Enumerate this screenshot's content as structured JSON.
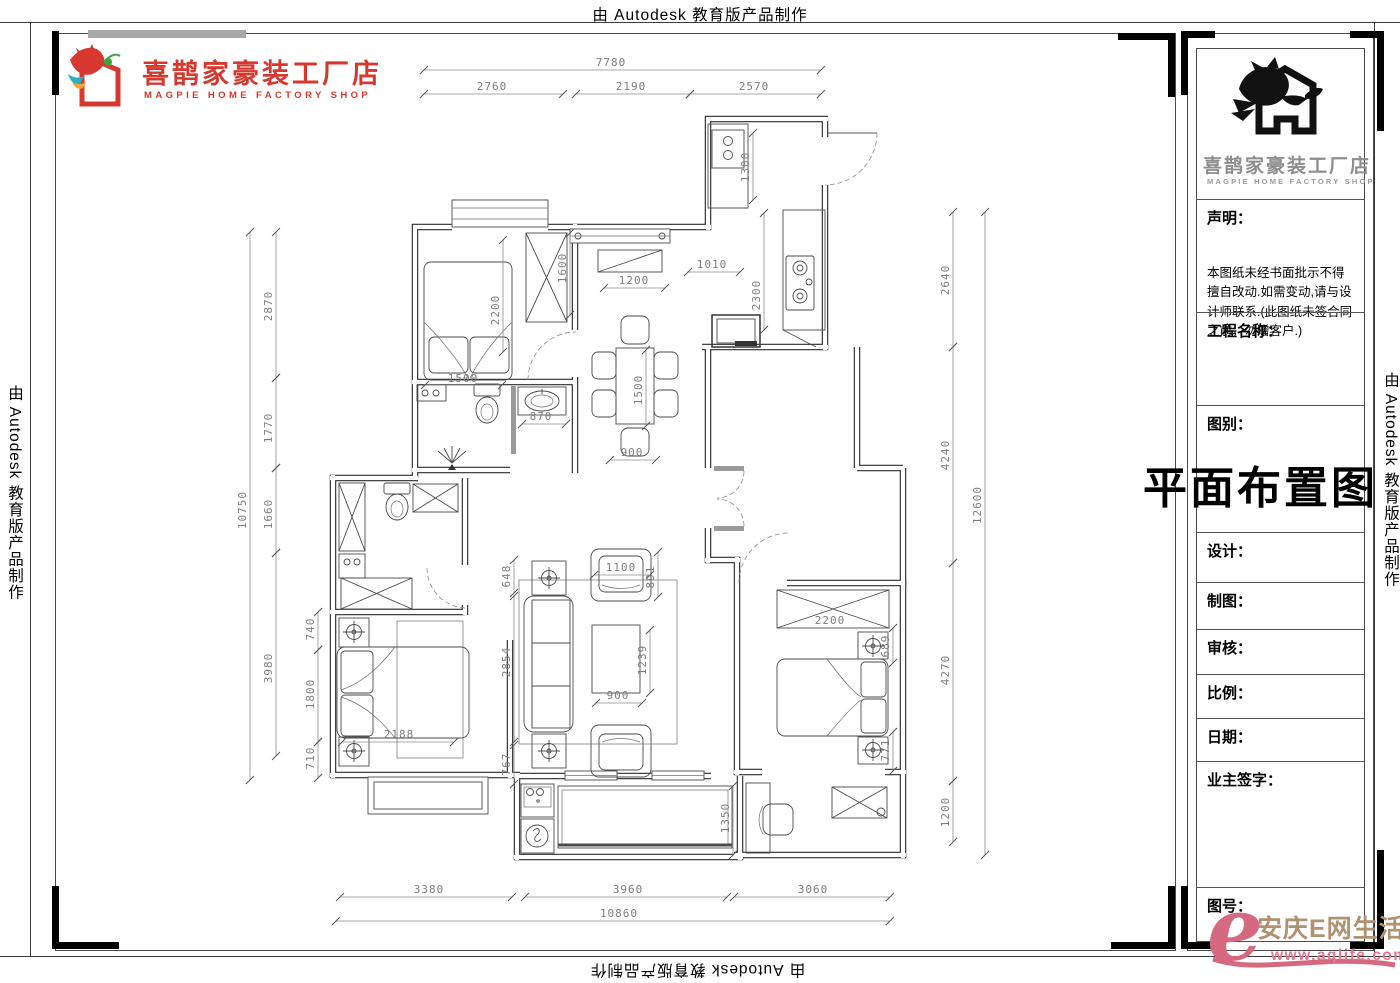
{
  "border_texts": {
    "top": "由 Autodesk 教育版产品制作",
    "left": "由 Autodesk 教育版产品制作",
    "right": "由 Autodesk 教育版产品制作",
    "bottom": "由 Autodesk 教育版产品制作"
  },
  "brand": {
    "name_cn": "喜鹊家豪装工厂店",
    "name_en": "MAGPIE HOME FACTORY SHOP",
    "color": "#d6382f"
  },
  "title_block": {
    "logo_cn": "喜鹊家豪装工厂店",
    "logo_en": "MAGPIE HOME FACTORY SHOP",
    "statement_label": "声明：",
    "statement_text": "本图纸未经书面批示不得擅自改动.如需变动,请与设计师联系.(此图纸未签合同之前，勿赠客户.)",
    "project_label": "工程名称：",
    "category_label": "图别：",
    "drawing_title": "平面布置图",
    "designer_label": "设计：",
    "drafter_label": "制图：",
    "reviewer_label": "审核：",
    "scale_label": "比例：",
    "date_label": "日期：",
    "owner_sign_label": "业主签字：",
    "sheet_no_label": "图号："
  },
  "watermark": {
    "mark": "e",
    "site_cn": "安庆E网生活",
    "site_url": "www.aqlife.com"
  },
  "plan": {
    "dimensions": [
      {
        "v": "7780",
        "x1": 424,
        "y1": 70,
        "x2": 821,
        "y2": 70,
        "lx": 611,
        "ly": 66
      },
      {
        "v": "2760",
        "x1": 424,
        "y1": 94,
        "x2": 563,
        "y2": 94,
        "lx": 492,
        "ly": 90
      },
      {
        "v": "2190",
        "x1": 576,
        "y1": 94,
        "x2": 690,
        "y2": 94,
        "lx": 631,
        "ly": 90
      },
      {
        "v": "2570",
        "x1": 690,
        "y1": 94,
        "x2": 821,
        "y2": 94,
        "lx": 754,
        "ly": 90
      },
      {
        "v": "10750",
        "x1": 250,
        "y1": 232,
        "x2": 250,
        "y2": 780,
        "lx": 246,
        "ly": 510,
        "r": -90
      },
      {
        "v": "2870",
        "x1": 276,
        "y1": 232,
        "x2": 276,
        "y2": 378,
        "lx": 272,
        "ly": 306,
        "r": -90
      },
      {
        "v": "1770",
        "x1": 276,
        "y1": 378,
        "x2": 276,
        "y2": 468,
        "lx": 272,
        "ly": 428,
        "r": -90
      },
      {
        "v": "1660",
        "x1": 276,
        "y1": 468,
        "x2": 276,
        "y2": 553,
        "lx": 272,
        "ly": 514,
        "r": -90
      },
      {
        "v": "3980",
        "x1": 276,
        "y1": 553,
        "x2": 276,
        "y2": 756,
        "lx": 272,
        "ly": 668,
        "r": -90
      },
      {
        "v": "2640",
        "x1": 953,
        "y1": 212,
        "x2": 953,
        "y2": 347,
        "lx": 949,
        "ly": 280,
        "r": -90
      },
      {
        "v": "4240",
        "x1": 953,
        "y1": 347,
        "x2": 953,
        "y2": 563,
        "lx": 949,
        "ly": 455,
        "r": -90
      },
      {
        "v": "4270",
        "x1": 953,
        "y1": 563,
        "x2": 953,
        "y2": 781,
        "lx": 949,
        "ly": 670,
        "r": -90
      },
      {
        "v": "1200",
        "x1": 953,
        "y1": 781,
        "x2": 953,
        "y2": 842,
        "lx": 949,
        "ly": 812,
        "r": -90
      },
      {
        "v": "12600",
        "x1": 985,
        "y1": 212,
        "x2": 985,
        "y2": 855,
        "lx": 981,
        "ly": 505,
        "r": -90
      },
      {
        "v": "3380",
        "x1": 340,
        "y1": 897,
        "x2": 512,
        "y2": 897,
        "lx": 429,
        "ly": 893
      },
      {
        "v": "3960",
        "x1": 525,
        "y1": 897,
        "x2": 727,
        "y2": 897,
        "lx": 628,
        "ly": 893
      },
      {
        "v": "3060",
        "x1": 734,
        "y1": 897,
        "x2": 890,
        "y2": 897,
        "lx": 813,
        "ly": 893
      },
      {
        "v": "10860",
        "x1": 336,
        "y1": 921,
        "x2": 890,
        "y2": 921,
        "lx": 619,
        "ly": 917
      },
      {
        "v": "1300",
        "x1": 753,
        "y1": 133,
        "x2": 753,
        "y2": 200,
        "lx": 749,
        "ly": 167,
        "r": -90
      },
      {
        "v": "2300",
        "x1": 764,
        "y1": 213,
        "x2": 764,
        "y2": 330,
        "lx": 760,
        "ly": 295,
        "r": -90
      },
      {
        "v": "1010",
        "x1": 688,
        "y1": 272,
        "x2": 740,
        "y2": 272,
        "lx": 712,
        "ly": 268
      },
      {
        "v": "1200",
        "x1": 604,
        "y1": 288,
        "x2": 665,
        "y2": 288,
        "lx": 634,
        "ly": 284
      },
      {
        "v": "1600",
        "x1": 570,
        "y1": 233,
        "x2": 570,
        "y2": 315,
        "lx": 566,
        "ly": 268,
        "r": -90
      },
      {
        "v": "2200",
        "x1": 503,
        "y1": 240,
        "x2": 503,
        "y2": 352,
        "lx": 499,
        "ly": 310,
        "r": -90
      },
      {
        "v": "1500",
        "x1": 425,
        "y1": 385,
        "x2": 502,
        "y2": 385,
        "lx": 463,
        "ly": 382
      },
      {
        "v": "870",
        "x1": 522,
        "y1": 424,
        "x2": 566,
        "y2": 424,
        "lx": 541,
        "ly": 420
      },
      {
        "v": "1500",
        "x1": 646,
        "y1": 350,
        "x2": 646,
        "y2": 426,
        "lx": 642,
        "ly": 390,
        "r": -90
      },
      {
        "v": "900",
        "x1": 610,
        "y1": 460,
        "x2": 656,
        "y2": 460,
        "lx": 632,
        "ly": 456
      },
      {
        "v": "648",
        "x1": 514,
        "y1": 560,
        "x2": 514,
        "y2": 593,
        "lx": 510,
        "ly": 576,
        "r": -90
      },
      {
        "v": "2854",
        "x1": 514,
        "y1": 596,
        "x2": 514,
        "y2": 742,
        "lx": 510,
        "ly": 662,
        "r": -90
      },
      {
        "v": "767",
        "x1": 514,
        "y1": 745,
        "x2": 514,
        "y2": 784,
        "lx": 510,
        "ly": 764,
        "r": -90
      },
      {
        "v": "1100",
        "x1": 594,
        "y1": 575,
        "x2": 650,
        "y2": 575,
        "lx": 621,
        "ly": 571
      },
      {
        "v": "891",
        "x1": 658,
        "y1": 552,
        "x2": 658,
        "y2": 597,
        "lx": 654,
        "ly": 577,
        "r": -90
      },
      {
        "v": "1239",
        "x1": 650,
        "y1": 630,
        "x2": 650,
        "y2": 693,
        "lx": 646,
        "ly": 660,
        "r": -90
      },
      {
        "v": "900",
        "x1": 596,
        "y1": 703,
        "x2": 642,
        "y2": 703,
        "lx": 618,
        "ly": 699
      },
      {
        "v": "740",
        "x1": 318,
        "y1": 612,
        "x2": 318,
        "y2": 650,
        "lx": 314,
        "ly": 629,
        "r": -90
      },
      {
        "v": "1800",
        "x1": 318,
        "y1": 650,
        "x2": 318,
        "y2": 742,
        "lx": 314,
        "ly": 694,
        "r": -90
      },
      {
        "v": "710",
        "x1": 318,
        "y1": 742,
        "x2": 318,
        "y2": 778,
        "lx": 314,
        "ly": 758,
        "r": -90
      },
      {
        "v": "2188",
        "x1": 342,
        "y1": 742,
        "x2": 454,
        "y2": 742,
        "lx": 399,
        "ly": 738
      },
      {
        "v": "2200",
        "lx": 830,
        "ly": 624
      },
      {
        "v": "689",
        "x1": 893,
        "y1": 628,
        "x2": 893,
        "y2": 663,
        "lx": 889,
        "ly": 646,
        "r": -90
      },
      {
        "v": "771",
        "x1": 893,
        "y1": 732,
        "x2": 893,
        "y2": 771,
        "lx": 889,
        "ly": 750,
        "r": -90
      },
      {
        "v": "1350",
        "x1": 733,
        "y1": 786,
        "x2": 733,
        "y2": 855,
        "lx": 729,
        "ly": 818,
        "r": -90
      }
    ]
  }
}
